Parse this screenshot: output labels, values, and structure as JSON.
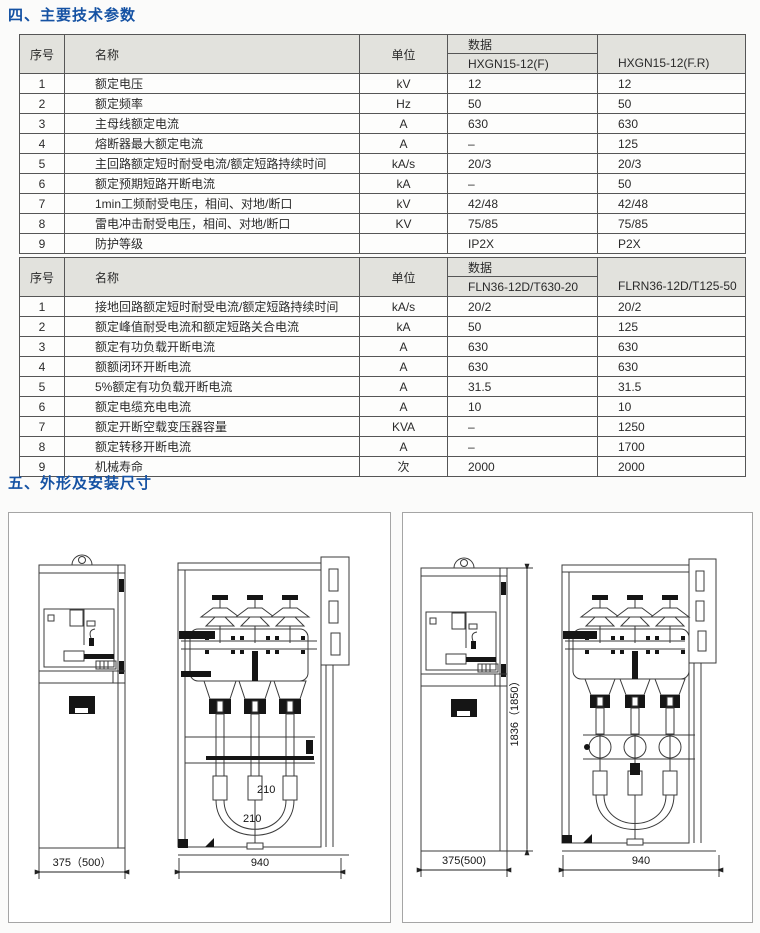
{
  "page": {
    "section4_title": "四、主要技术参数",
    "section5_title": "五、外形及安装尺寸"
  },
  "colors": {
    "title_blue": "#1552a3",
    "table_header_bg": "#e2e2dd",
    "table_border": "#565656",
    "panel_border": "#a5a5a5"
  },
  "table1": {
    "headers": {
      "no": "序号",
      "name": "名称",
      "unit": "单位",
      "data": "数据",
      "model1": "HXGN15-12(F)",
      "model2": "HXGN15-12(F.R)"
    },
    "rows": [
      {
        "no": "1",
        "name": "额定电压",
        "unit": "kV",
        "v1": "12",
        "v2": "12"
      },
      {
        "no": "2",
        "name": "额定频率",
        "unit": "Hz",
        "v1": "50",
        "v2": "50"
      },
      {
        "no": "3",
        "name": "主母线额定电流",
        "unit": "A",
        "v1": "630",
        "v2": "630"
      },
      {
        "no": "4",
        "name": "熔断器最大额定电流",
        "unit": "A",
        "v1": "–",
        "v2": "125"
      },
      {
        "no": "5",
        "name": "主回路额定短时耐受电流/额定短路持续时间",
        "unit": "kA/s",
        "v1": "20/3",
        "v2": "20/3"
      },
      {
        "no": "6",
        "name": "额定预期短路开断电流",
        "unit": "kA",
        "v1": "–",
        "v2": "50"
      },
      {
        "no": "7",
        "name": "1min工频耐受电压，相间、对地/断口",
        "unit": "kV",
        "v1": "42/48",
        "v2": "42/48"
      },
      {
        "no": "8",
        "name": "雷电冲击耐受电压，相间、对地/断口",
        "unit": "KV",
        "v1": "75/85",
        "v2": "75/85"
      },
      {
        "no": "9",
        "name": "防护等级",
        "unit": "",
        "v1": "IP2X",
        "v2": "P2X"
      }
    ]
  },
  "table2": {
    "headers": {
      "no": "序号",
      "name": "名称",
      "unit": "单位",
      "data": "数据",
      "model1": "FLN36-12D/T630-20",
      "model2": "FLRN36-12D/T125-50"
    },
    "rows": [
      {
        "no": "1",
        "name": "接地回路额定短时耐受电流/额定短路持续时间",
        "unit": "kA/s",
        "v1": "20/2",
        "v2": "20/2"
      },
      {
        "no": "2",
        "name": "额定峰值耐受电流和额定短路关合电流",
        "unit": "kA",
        "v1": "50",
        "v2": "125"
      },
      {
        "no": "3",
        "name": "额定有功负载开断电流",
        "unit": "A",
        "v1": "630",
        "v2": "630"
      },
      {
        "no": "4",
        "name": "额额闭环开断电流",
        "unit": "A",
        "v1": "630",
        "v2": "630"
      },
      {
        "no": "5",
        "name": "5%额定有功负载开断电流",
        "unit": "A",
        "v1": "31.5",
        "v2": "31.5"
      },
      {
        "no": "6",
        "name": "额定电缆充电电流",
        "unit": "A",
        "v1": "10",
        "v2": "10"
      },
      {
        "no": "7",
        "name": "额定开断空载变压器容量",
        "unit": "KVA",
        "v1": "–",
        "v2": "1250"
      },
      {
        "no": "8",
        "name": "额定转移开断电流",
        "unit": "A",
        "v1": "–",
        "v2": "1700"
      },
      {
        "no": "9",
        "name": "机械寿命",
        "unit": "次",
        "v1": "2000",
        "v2": "2000"
      }
    ]
  },
  "drawings": {
    "left_panel": {
      "side_width": "375（500）",
      "front_width": "940",
      "dim_210_upper": "210",
      "dim_210_lower": "210"
    },
    "right_panel": {
      "side_width": "375(500)",
      "front_width": "940",
      "side_height": "1836（1850）"
    }
  }
}
